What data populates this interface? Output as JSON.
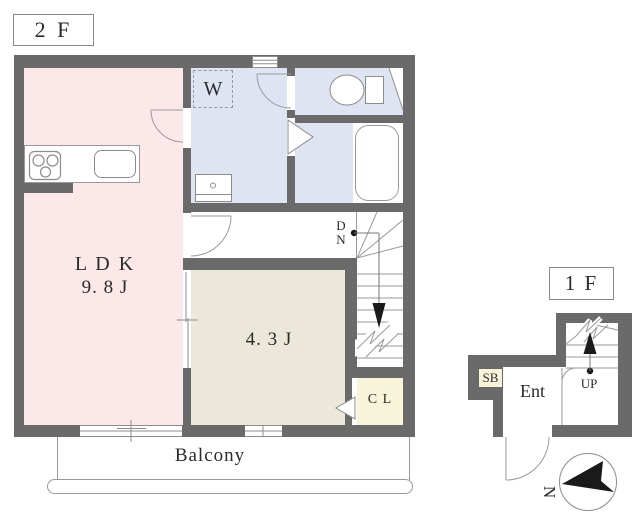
{
  "floor2": {
    "label": "2 F",
    "ldk_name": "L D K",
    "ldk_size": "9. 8 J",
    "bedroom_size": "4. 3 J",
    "closet_label": "C L",
    "laundry_label": "W",
    "balcony_label": "Balcony",
    "stairs_down_letter1": "D",
    "stairs_down_letter2": "N"
  },
  "floor1": {
    "label": "1 F",
    "shoe_box_label": "SB",
    "entrance_label": "Ent",
    "stairs_up_label": "UP"
  },
  "compass": {
    "north_label": "N"
  },
  "colors": {
    "wall": "#6a6a6a",
    "ldk_fill": "#fce7e9",
    "wet_area_fill": "#dee4f2",
    "bedroom_fill": "#ebe7d9",
    "closet_fill": "#f7f4da",
    "line": "#8c8c8c",
    "arrow_black": "#1a1a1a"
  },
  "icons": {
    "stove": "stove-icon",
    "sink": "sink-icon",
    "washbasin": "washbasin-icon",
    "toilet": "toilet-icon",
    "bathtub": "bathtub-icon",
    "down_arrow": "down-arrow-icon",
    "up_arrow": "up-arrow-icon",
    "north_arrow": "north-arrow-icon"
  }
}
